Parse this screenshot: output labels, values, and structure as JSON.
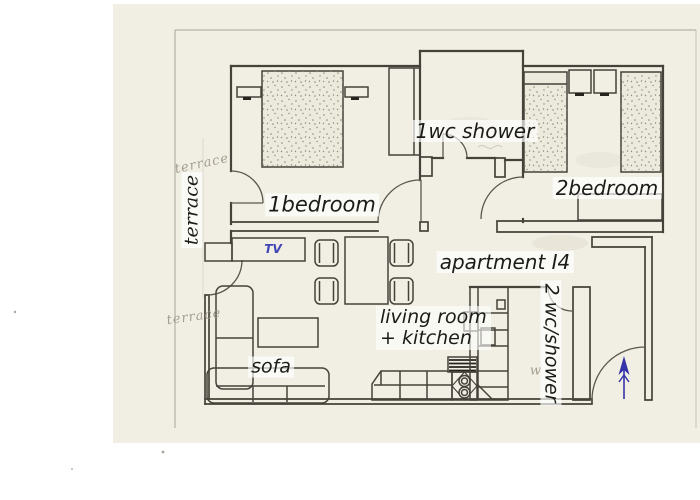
{
  "page": {
    "background": "#ffffff"
  },
  "paper": {
    "color": "#f1efe4"
  },
  "colors": {
    "ink": "#45423a",
    "label_text": "#1c1b18",
    "pencil": "#a39d8f",
    "tv_blue": "#3f45b4",
    "arrow_blue": "#3434a8",
    "frame": "#9a958a"
  },
  "labels": {
    "bedroom1": "1bedroom",
    "bedroom2": "2bedroom",
    "wc1": "1wc shower",
    "wc2": "2 wc/shower",
    "apartment": "apartment I4",
    "living_line1": "living room",
    "living_line2": "+ kitchen",
    "sofa": "sofa",
    "tv": "TV",
    "terrace_printed": "terrace",
    "terrace_pencil_top": "terrace",
    "terrace_pencil_bottom": "terrace",
    "pencil_note": "w"
  }
}
